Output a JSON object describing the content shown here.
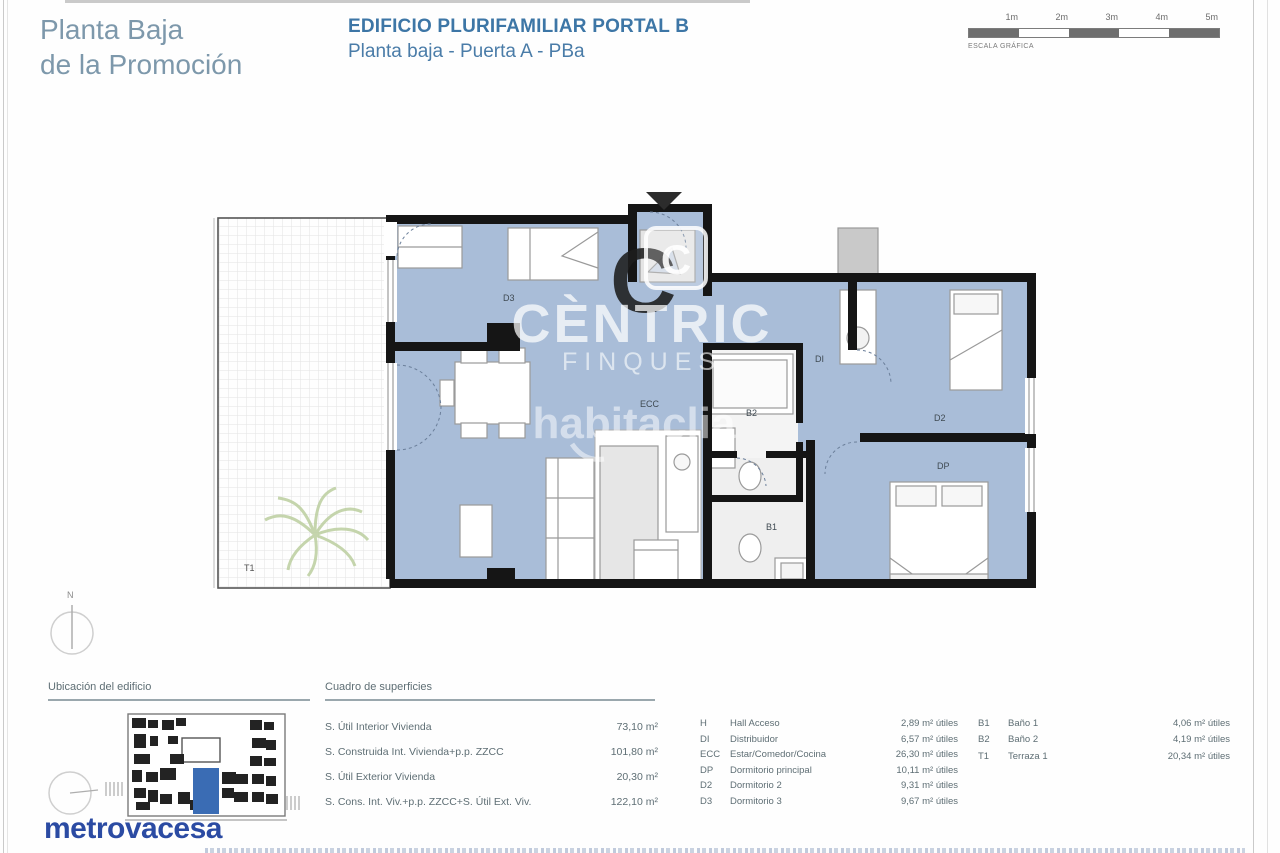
{
  "page": {
    "title_line1": "Planta Baja",
    "title_line2": "de la Promoción",
    "subtitle_line1": "EDIFICIO PLURIFAMILIAR PORTAL B",
    "subtitle_line2": "Planta baja - Puerta A - PBa"
  },
  "scale_bar": {
    "labels": [
      "1m",
      "2m",
      "3m",
      "4m",
      "5m"
    ],
    "caption": "ESCALA GRÁFICA"
  },
  "floorplan": {
    "compass_label": "N",
    "room_labels": {
      "t1": "T1",
      "d3": "D3",
      "ecc": "ECC",
      "di": "DI",
      "b2": "B2",
      "b1": "B1",
      "d2": "D2",
      "dp": "DP"
    },
    "watermark": {
      "logo_letter": "C",
      "brand": "CÈNTRIC",
      "brand_sub": "FINQUES",
      "portal": "habitaclia"
    }
  },
  "location_map": {
    "title": "Ubicación del edificio"
  },
  "surfaces_table": {
    "title": "Cuadro de superficies",
    "rows": [
      {
        "label": "S. Útil Interior Vivienda",
        "value": "73,10 m²"
      },
      {
        "label": "S. Construida Int. Vivienda+p.p. ZZCC",
        "value": "101,80 m²"
      },
      {
        "label": "S. Útil Exterior Vivienda",
        "value": "20,30 m²"
      },
      {
        "label": "S. Cons. Int. Viv.+p.p. ZZCC+S. Útil Ext. Viv.",
        "value": "122,10 m²"
      }
    ]
  },
  "rooms_legend": {
    "col1": [
      {
        "code": "H",
        "name": "Hall Acceso",
        "value": "2,89 m² útiles"
      },
      {
        "code": "DI",
        "name": "Distribuidor",
        "value": "6,57 m² útiles"
      },
      {
        "code": "ECC",
        "name": "Estar/Comedor/Cocina",
        "value": "26,30 m² útiles"
      },
      {
        "code": "DP",
        "name": "Dormitorio principal",
        "value": "10,11 m² útiles"
      },
      {
        "code": "D2",
        "name": "Dormitorio 2",
        "value": "9,31 m² útiles"
      },
      {
        "code": "D3",
        "name": "Dormitorio 3",
        "value": "9,67 m² útiles"
      }
    ],
    "col2": [
      {
        "code": "B1",
        "name": "Baño 1",
        "value": "4,06 m² útiles"
      },
      {
        "code": "B2",
        "name": "Baño 2",
        "value": "4,19 m² útiles"
      },
      {
        "code": "T1",
        "name": "Terraza 1",
        "value": "20,34 m² útiles"
      }
    ]
  },
  "brand": {
    "developer": "metrovacesa"
  },
  "colors": {
    "room_fill": "#a9bdd8",
    "wall": "#151515",
    "accent_blue": "#4a7ca8",
    "title_gray": "#7d98ab",
    "metrovacesa_blue": "#2b4ba3",
    "map_unit_blue": "#3a6cb4"
  }
}
